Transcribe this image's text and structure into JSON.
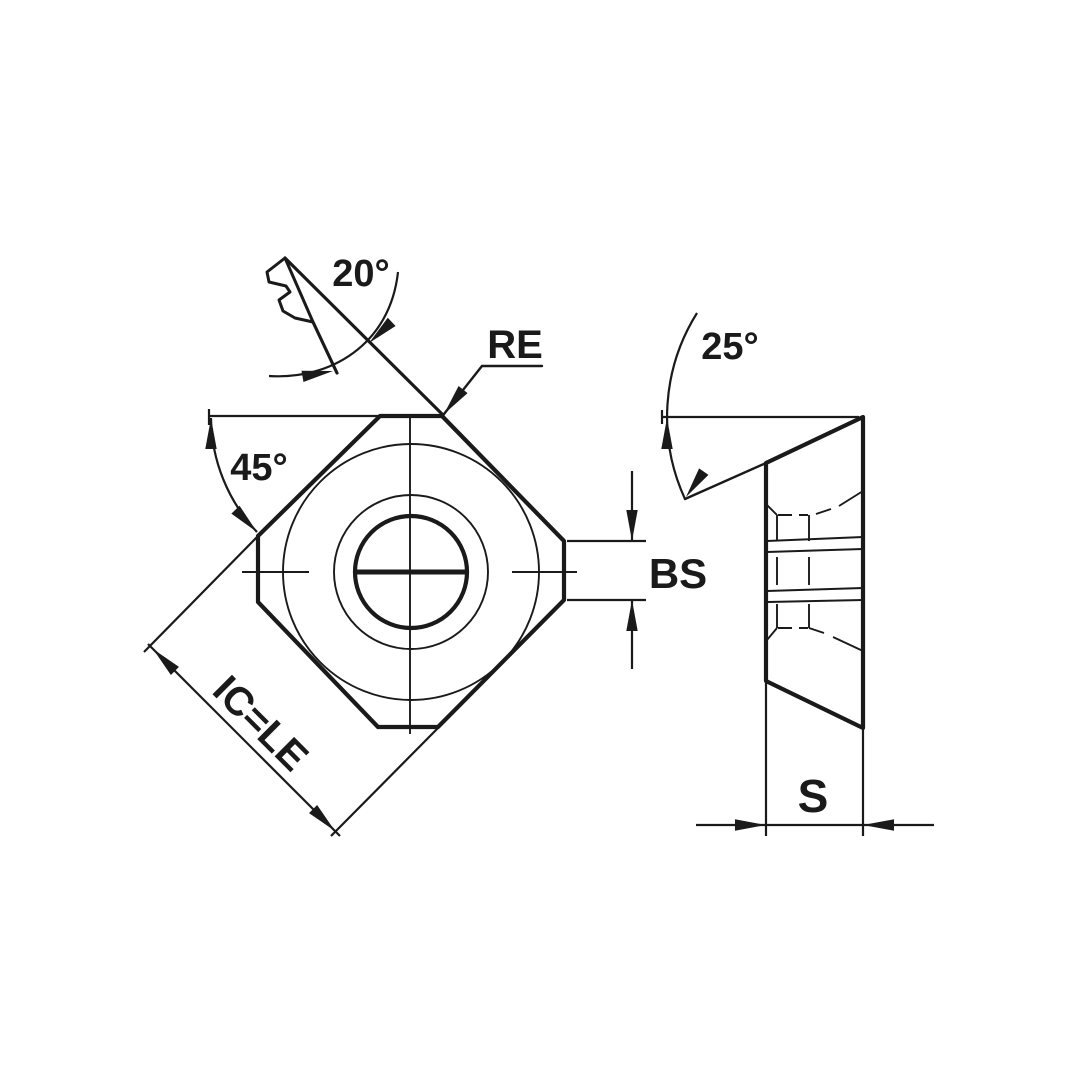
{
  "drawing": {
    "background": "#ffffff",
    "ink": "#1a1a1a",
    "type": "insert-engineering-drawing",
    "views": {
      "front_view": "square insert, 45-deg rotated, corner facets, center hole",
      "side_view": "thickness profile with through-hole section"
    },
    "labels": {
      "lead_angle": "20°",
      "corner_radius": "RE",
      "relief_angle": "25°",
      "facet_angle": "45°",
      "wiper_width": "BS",
      "size": "IC=LE",
      "thickness": "S"
    }
  }
}
